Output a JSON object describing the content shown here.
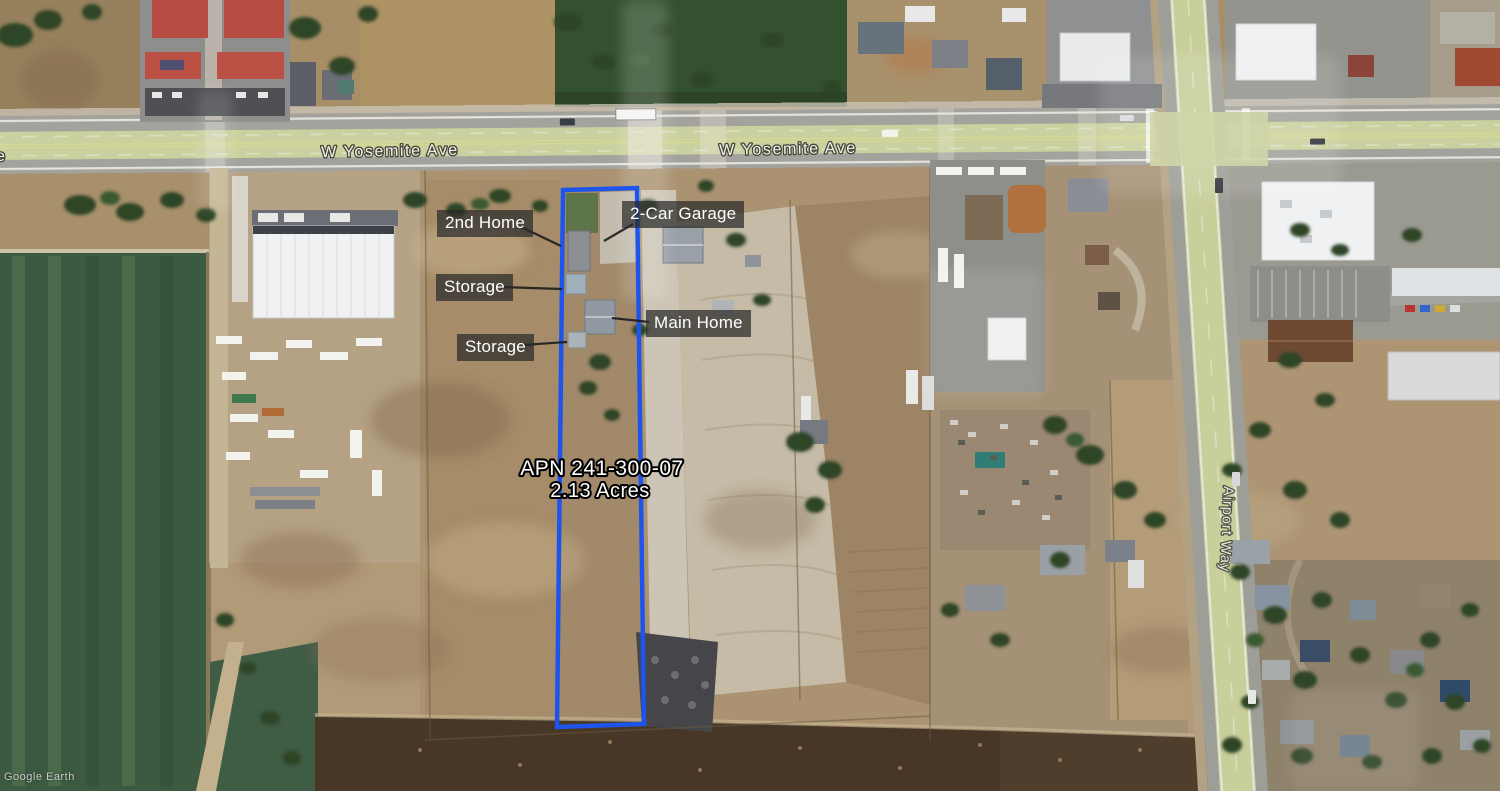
{
  "map_type": "satellite-aerial",
  "watermark": "Google Earth",
  "streets": {
    "yosemite_west_label": "W Yosemite Ave",
    "yosemite_east_label": "W Yosemite Ave",
    "yosemite_partial_label": "e",
    "airport_way_label": "Airport Way"
  },
  "parcel": {
    "apn_label": "APN 241-300-07",
    "acreage_label": "2.13 Acres",
    "outline_color": "#1d55ec"
  },
  "annotations": {
    "second_home": "2nd Home",
    "two_car_garage": "2-Car Garage",
    "storage_upper": "Storage",
    "storage_lower": "Storage",
    "main_home": "Main Home"
  },
  "colors": {
    "road_tint": "#cbd19e",
    "field_green": "#3c5a42",
    "label_background": "rgba(42,42,42,0.72)",
    "label_text": "#ffffff"
  }
}
